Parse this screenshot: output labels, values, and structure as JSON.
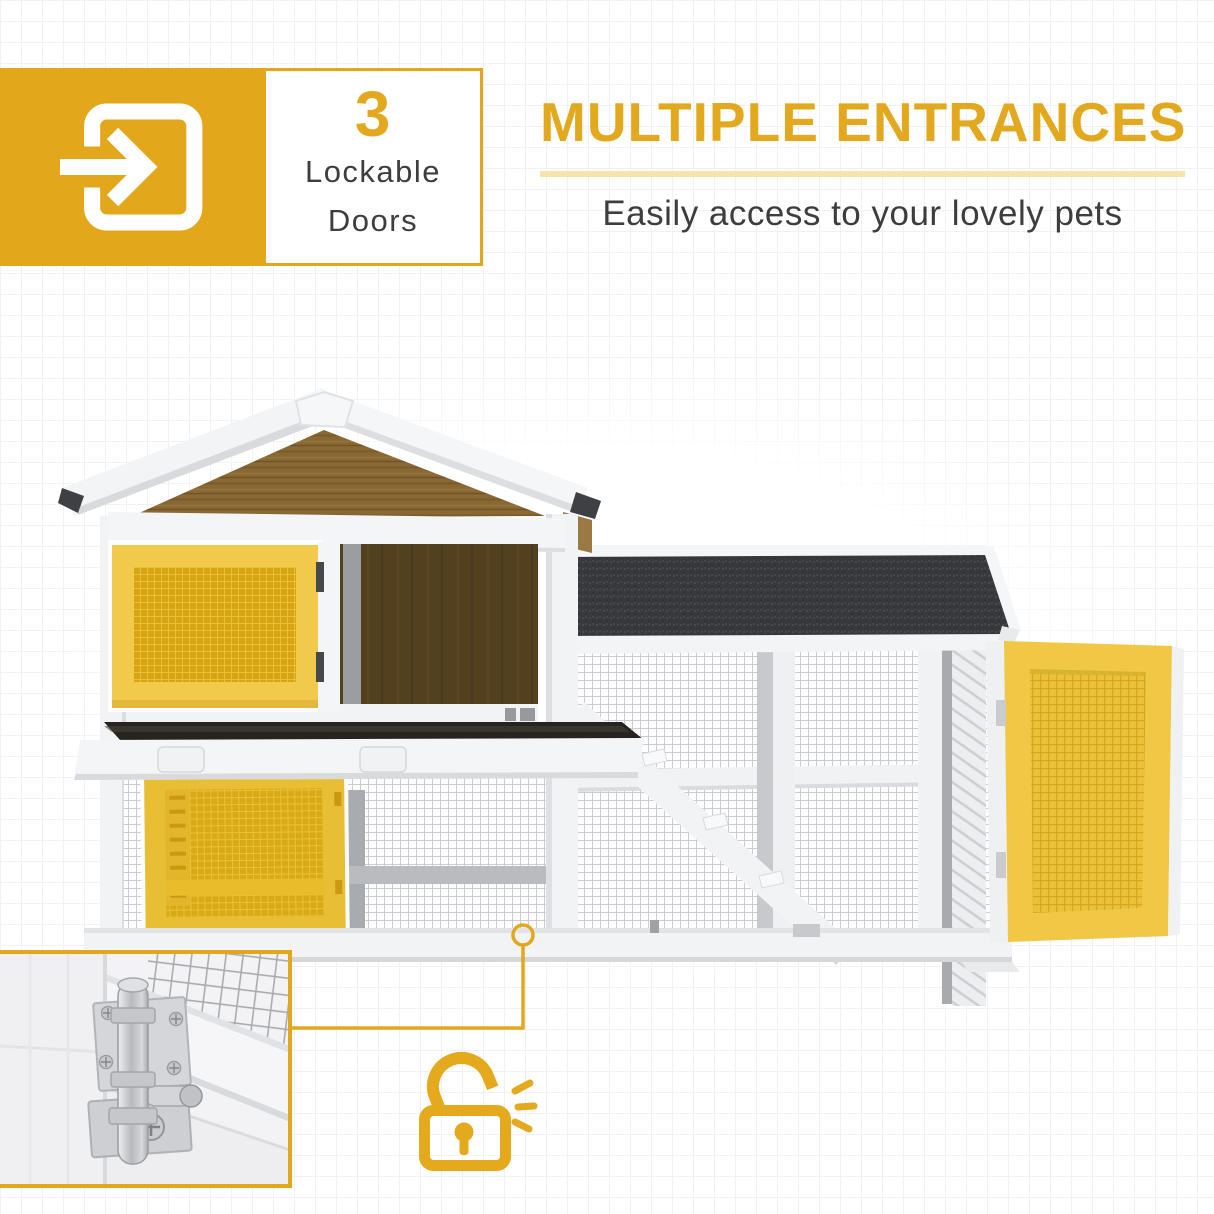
{
  "colors": {
    "accent": "#e2a71b",
    "heading": "#e2a81e",
    "divider": "#f6e4ac",
    "text_dark": "#3d3d3d",
    "door_frame_yellow": "#f1c94b",
    "door_mesh_yellow": "#d7a413",
    "roof_dark": "#38393d",
    "gable_wood_brown": "#8a6833",
    "interior_brown": "#52401f",
    "structure_white": "#f3f4f6"
  },
  "feature_badge": {
    "count": "3",
    "label_line1": "Lockable",
    "label_line2": "Doors",
    "icon": "door-enter-icon"
  },
  "header": {
    "title": "MULTIPLE ENTRANCES",
    "subtitle": "Easily access to your lovely pets"
  },
  "illustration": {
    "type": "product-photo",
    "subject": "two-story wooden pet hutch with gable roof, yellow mesh doors, pull-out tray, dark-roof wire run, ramp and open side door",
    "callouts": [
      "lock-position-circle",
      "lock-closeup-inset",
      "padlock-unlocked-icon"
    ]
  }
}
